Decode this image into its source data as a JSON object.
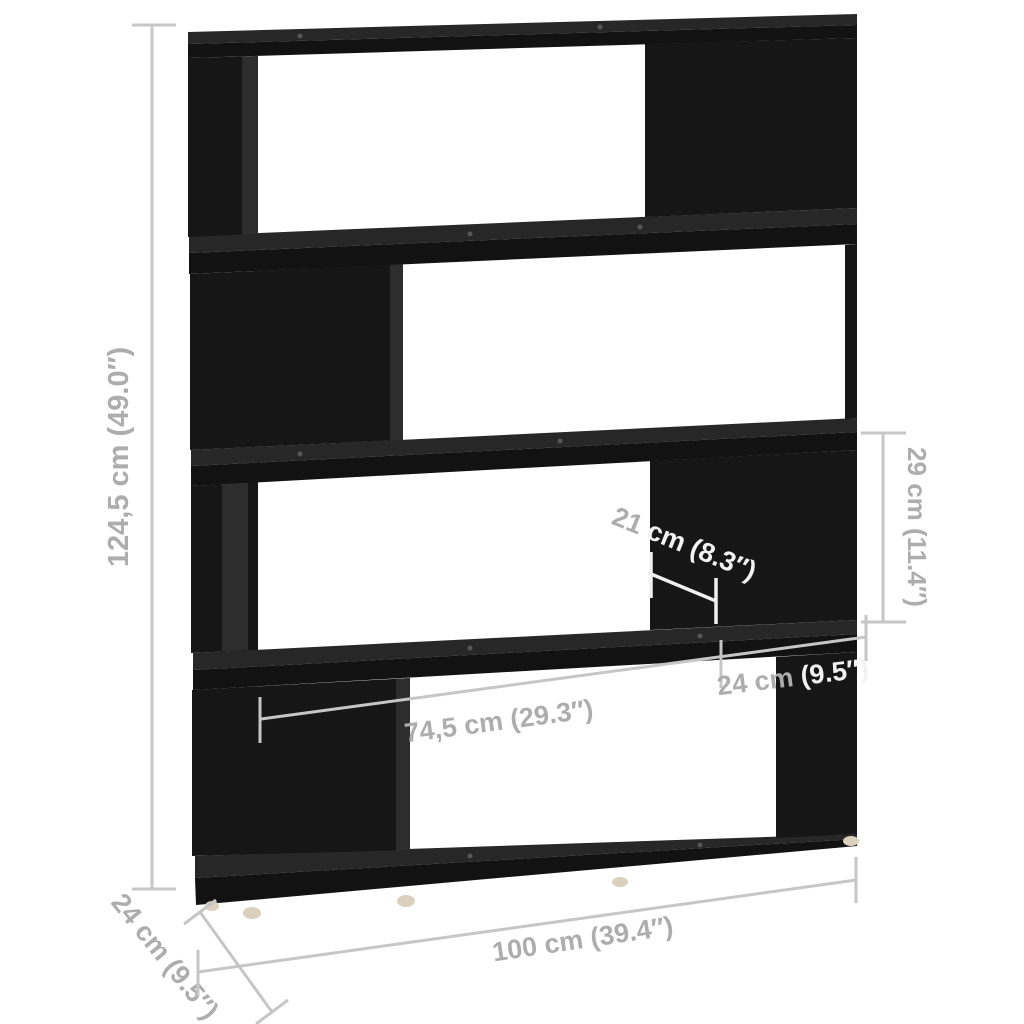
{
  "diagram": {
    "subject": "black 4-tier room divider bookshelf",
    "style": "product dimension diagram",
    "background": "#ffffff"
  },
  "labels": {
    "height": "124,5 cm (49.0″)",
    "width": "100 cm (39.4″)",
    "depth": "24 cm (9.5″)",
    "inner_width": "74,5 cm (29.3″)",
    "side_width": "24 cm (9.5″)",
    "side_width_part1": "24 cm ",
    "side_width_part2": "(9.5″)",
    "panel_width": "21 cm (8.3″)",
    "panel_width_part1": "21 ",
    "panel_width_part2": "cm (8.3″)",
    "opening_height": "29 cm (11.4″)"
  },
  "values": {
    "height_cm": "124,5",
    "height_in": "49.0",
    "width_cm": "100",
    "width_in": "39.4",
    "depth_cm": "24",
    "depth_in": "9.5",
    "inner_width_cm": "74,5",
    "inner_width_in": "29.3",
    "side_width_cm": "24",
    "side_width_in": "9.5",
    "panel_width_cm": "21",
    "panel_width_in": "8.3",
    "opening_height_cm": "29",
    "opening_height_in": "11.4"
  },
  "colors": {
    "furniture_front": "#141414",
    "furniture_top_surface": "#272727",
    "furniture_inner_side": "#2d2d2d",
    "dimension_line": "#c6c6c6",
    "dimension_line_on_dark": "#f0f0f0",
    "label_text": "#adadad",
    "label_text_on_dark": "#f2f2f2",
    "feet": "#d9d0bd"
  }
}
